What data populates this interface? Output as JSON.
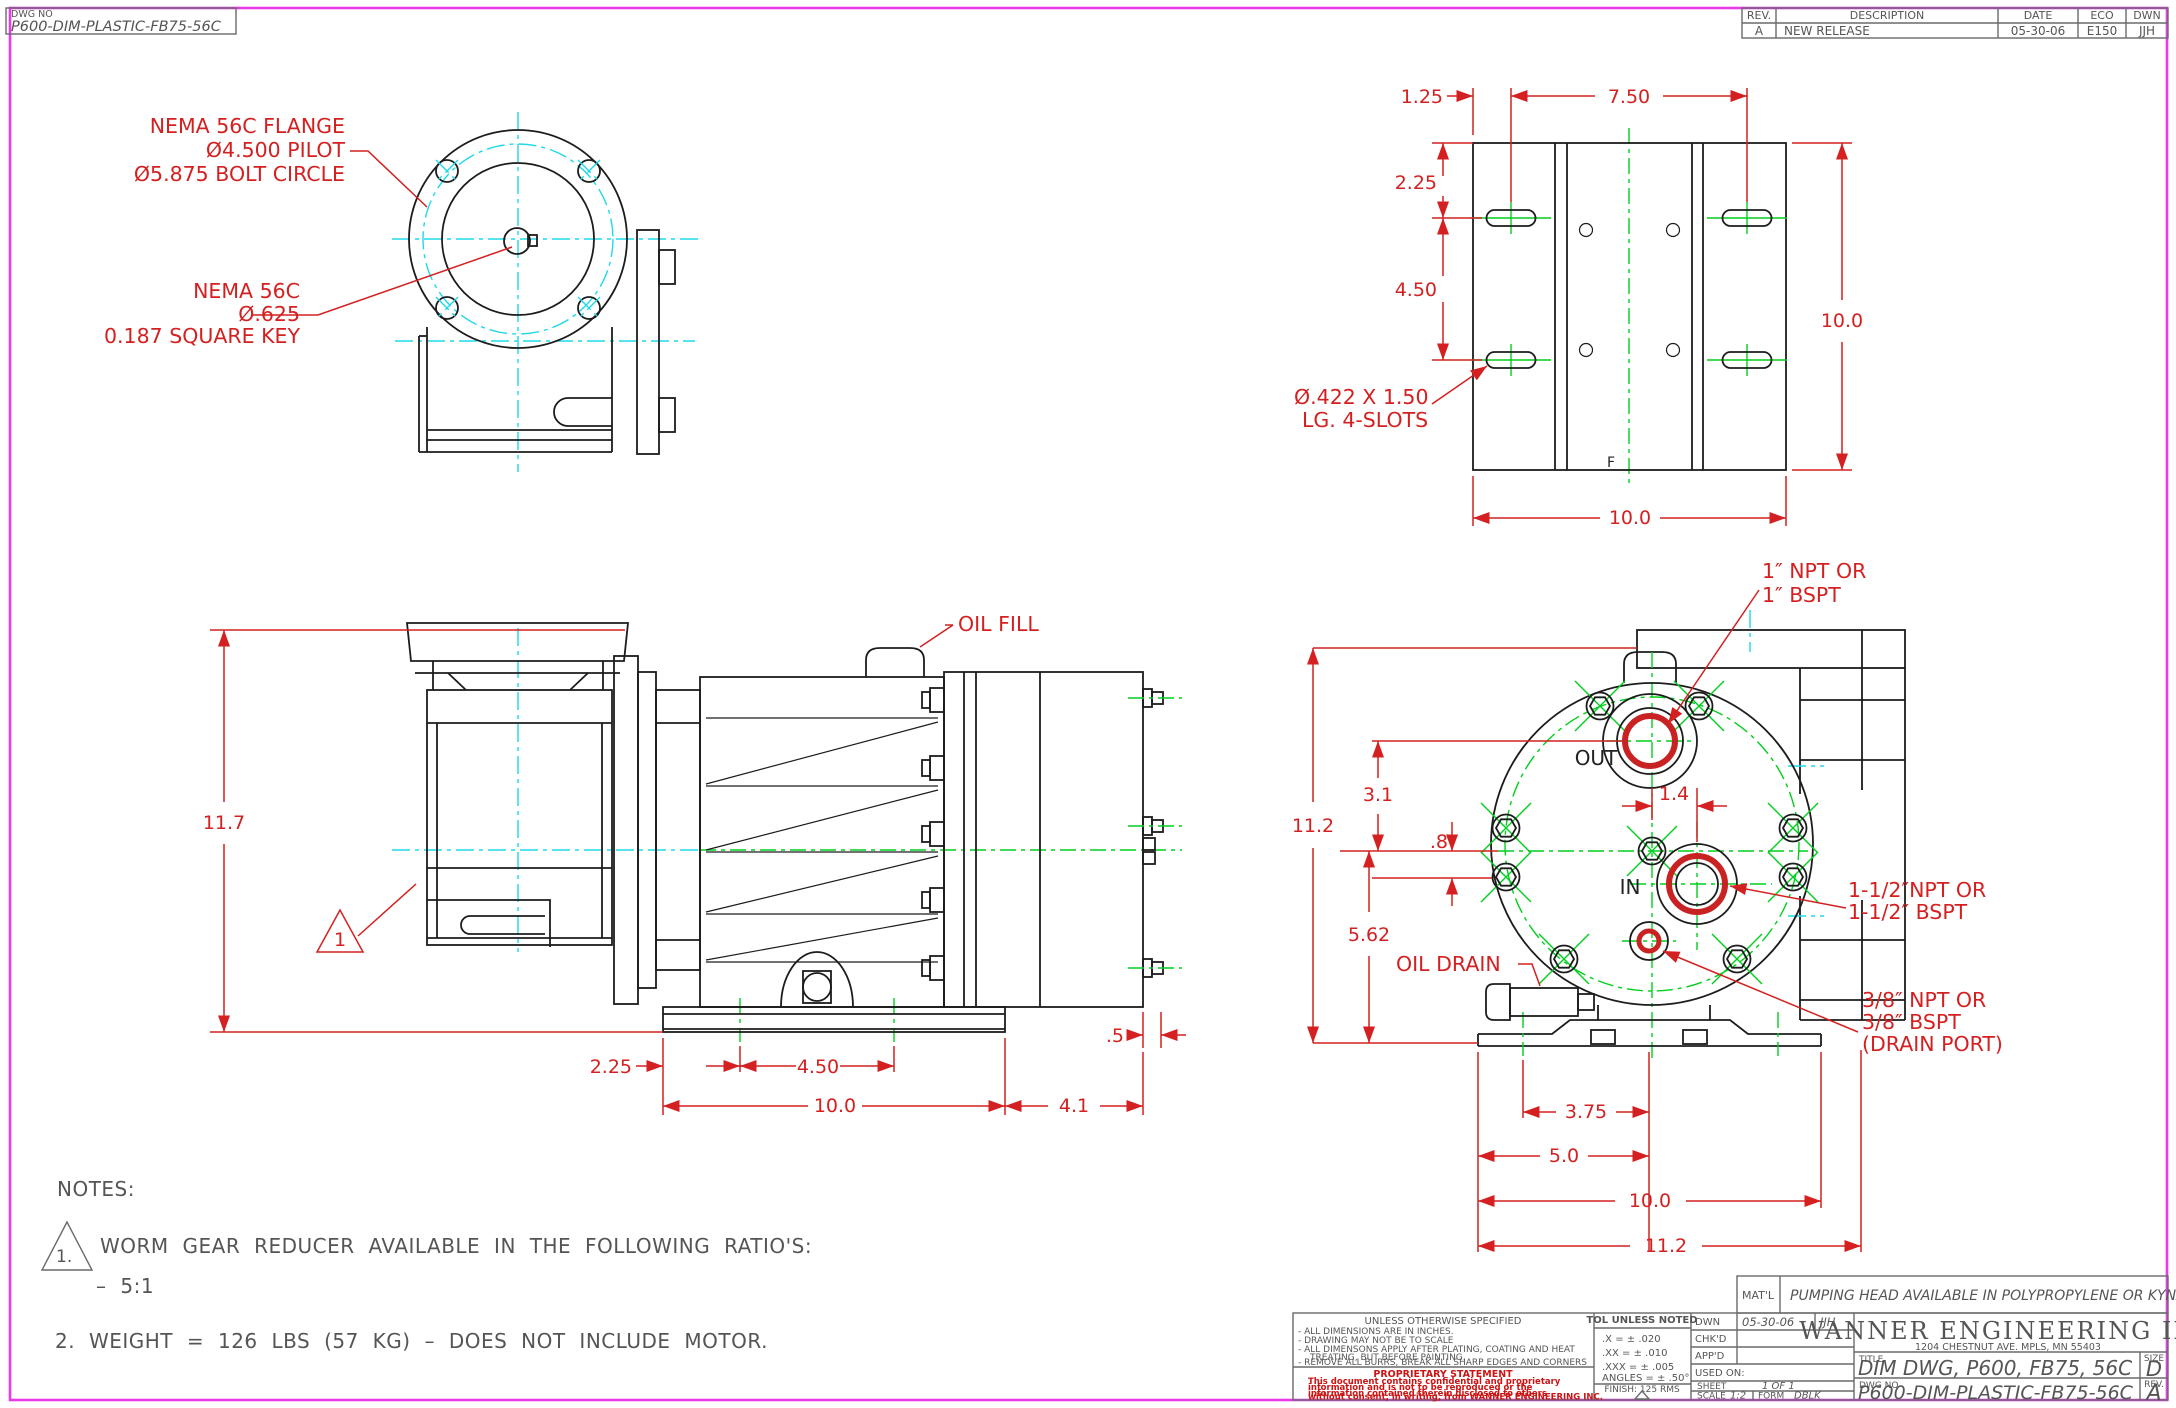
{
  "colors": {
    "dimension_red": "#d42020",
    "centerline_cyan": "#1fd9e9",
    "centerline_green": "#00cf1d",
    "border_magenta": "#e83ae8",
    "line_black": "#1c1c1c"
  },
  "dwg_box": {
    "label": "DWG  NO",
    "value": "P600-DIM-PLASTIC-FB75-56C"
  },
  "rev_table": {
    "h_rev": "REV.",
    "h_desc": "DESCRIPTION",
    "h_date": "DATE",
    "h_eco": "ECO",
    "h_dwn": "DWN",
    "r_rev": "A",
    "r_desc": "NEW  RELEASE",
    "r_date": "05-30-06",
    "r_eco": "E150",
    "r_dwn": "JJH"
  },
  "flange_view": {
    "c1a": "NEMA 56C FLANGE",
    "c1b": "Ø4.500 PILOT",
    "c1c": "Ø5.875 BOLT CIRCLE",
    "c2a": "NEMA 56C",
    "c2b": "Ø.625",
    "c2c": "0.187 SQUARE KEY"
  },
  "plate_view": {
    "d_offset": "1.25",
    "d_span": "7.50",
    "d_top": "2.25",
    "d_mid": "4.50",
    "d_height": "10.0",
    "d_width": "10.0",
    "slot1": "Ø.422 X 1.50",
    "slot2": "LG. 4-SLOTS",
    "marker": "F"
  },
  "side_view": {
    "d_height": "11.7",
    "oil_fill": "OIL FILL",
    "flag": "1",
    "d_base1": "2.25",
    "d_base2": "4.50",
    "d_base": "10.0",
    "d_head": "4.1",
    "d_bolt": ".5"
  },
  "front_view": {
    "out": "OUT",
    "in": "IN",
    "oil_drain": "OIL DRAIN",
    "c1a": "1″ NPT OR",
    "c1b": "1″ BSPT",
    "c2a": "1-1/2″NPT OR",
    "c2b": "1-1/2″ BSPT",
    "c3a": "3/8″ NPT OR",
    "c3b": "3/8″ BSPT",
    "c3c": "(DRAIN PORT)",
    "d31": "3.1",
    "d112": "11.2",
    "d8": ".8",
    "d562": "5.62",
    "d14": "1.4",
    "d375": "3.75",
    "d50": "5.0",
    "d100": "10.0",
    "d112b": "11.2"
  },
  "notes": {
    "heading": "NOTES:",
    "flag": "1.",
    "n1": "WORM  GEAR  REDUCER  AVAILABLE  IN  THE  FOLLOWING  RATIO'S:",
    "n1b": "–  5:1",
    "n2": "2. WEIGHT  =  126  LBS  (57  KG)  –  DOES  NOT  INCLUDE  MOTOR."
  },
  "title_block": {
    "matl_label": "MAT'L",
    "matl_value": "PUMPING  HEAD  AVAILABLE  IN  POLYPROPYLENE  OR  KYNAR",
    "spec_heading": "UNLESS  OTHERWISE  SPECIFIED",
    "spec1": "-  ALL  DIMENSIONS  ARE  IN  INCHES.",
    "spec2": "-  DRAWING  MAY  NOT  BE  TO  SCALE",
    "spec3": "-  ALL  DIMENSONS  APPLY  AFTER  PLATING,  COATING  AND  HEAT",
    "spec3b": "TREATING,  BUT  BEFORE  PAINTING.",
    "spec4": "-  REMOVE  ALL  BURRS,  BREAK  ALL  SHARP  EDGES  AND  CORNERS",
    "prop_heading": "PROPRIETARY  STATEMENT",
    "prop1": "This  document  contains  confidential  and  proprietary",
    "prop2": "information  and  is  not  to  be  reproduced  or  the",
    "prop3": "information  contained  therein  disclosed  to  others",
    "prop4": "without  consent,  in  writing,  from  WANNER  ENGINEERING  INC.",
    "tol_heading": "TOL  UNLESS  NOTED",
    "tol_x": ".X     =  ±  .020",
    "tol_xx": ".XX    =  ±  .010",
    "tol_xxx": ".XXX  =  ±  .005",
    "tol_ang": "ANGLES  =  ±  .50°",
    "finish": "FINISH:  125  RMS",
    "dwn_label": "DWN",
    "dwn_date": "05-30-06",
    "dwn_by": "JJH",
    "chkd_label": "CHK'D",
    "appd_label": "APP'D",
    "used_on": "USED  ON:",
    "sheet_label": "SHEET",
    "sheet_value": "1  OF  1",
    "scale_label": "SCALE",
    "scale_value": "1:2",
    "form_label": "FORM",
    "form_value": "DBLK",
    "company": "WANNER  ENGINEERING  INC",
    "address": "1204 CHESTNUT AVE.  MPLS,  MN  55403",
    "title_label": "TITLE",
    "title_value": "DIM  DWG,  P600,  FB75,  56C",
    "size_label": "SIZE",
    "size_value": "D",
    "dwgno_label": "DWG   NO",
    "dwgno_value": "P600-DIM-PLASTIC-FB75-56C",
    "rev_label": "REV.",
    "rev_value": "A"
  }
}
